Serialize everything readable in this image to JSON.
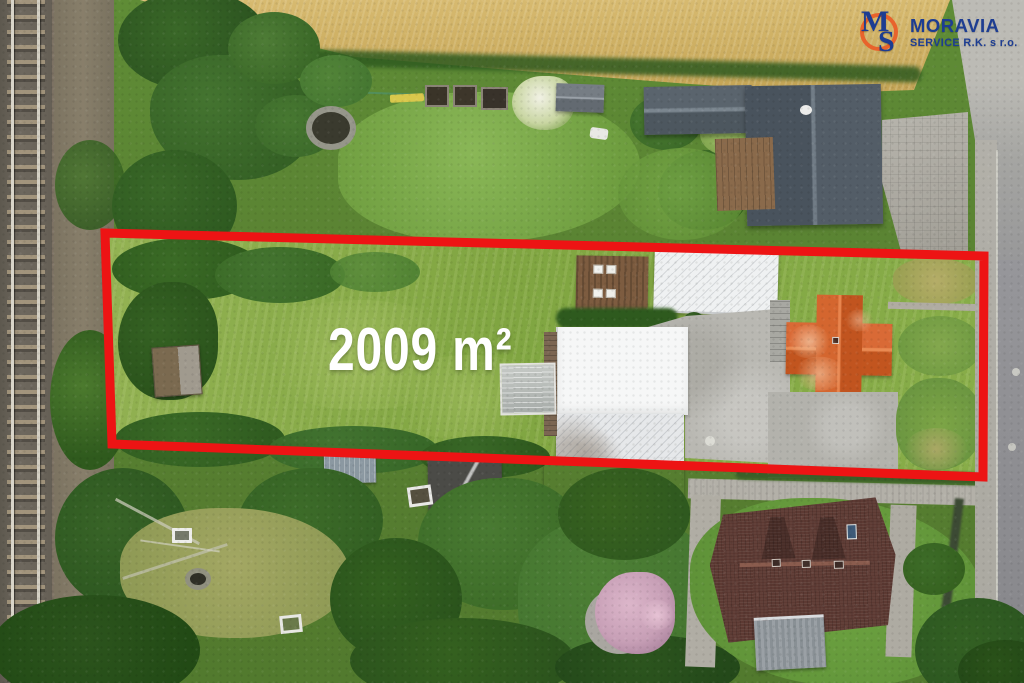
{
  "watermark": {
    "monogram_m": "M",
    "monogram_s": "S",
    "brand": "MORAVIA",
    "subtitle": "SERVICE R.K. s r.o.",
    "brand_color": "#1d3d92",
    "ring_color": "#e8632c"
  },
  "parcel": {
    "area_label": "2009 m²",
    "outline_color": "#ed1414"
  },
  "scene": {
    "description_colors": {
      "railway_ballast": "#6b655c",
      "wheat_field": "#cdae60",
      "road_asphalt": "#95959a",
      "parcel_meadow": "#8db04f",
      "slate_roof": "#515b65",
      "white_roof": "#f2f3f4",
      "orange_roof": "#cf5f2e",
      "brown_roof": "#5d3a33",
      "concrete_yard": "#b9b8b2"
    }
  }
}
